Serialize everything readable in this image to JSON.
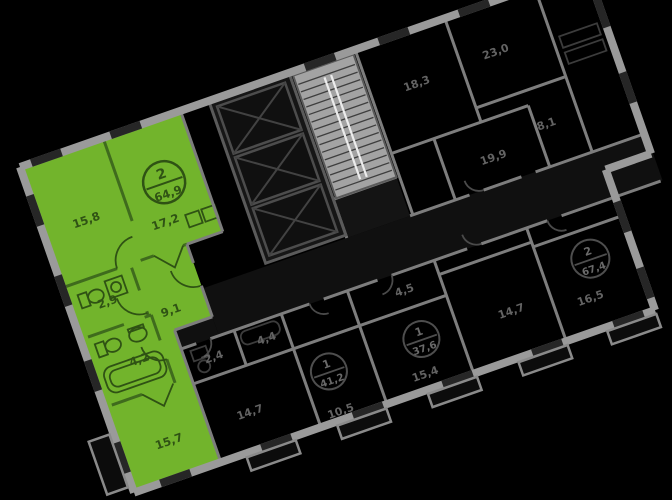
{
  "widget": {
    "name": "building-floor-plan",
    "type": "apartment-selector"
  },
  "selected_apartment": {
    "badge": {
      "rooms": "2",
      "area": "64,9"
    },
    "rooms": {
      "bedroom": "15,8",
      "living_kitchen": "17,2",
      "wc": "2,9",
      "hallway": "9,1",
      "bathroom": "4,2",
      "bedroom2": "15,7"
    },
    "highlight_color": "#72B42C"
  },
  "neighbors": {
    "b1": {
      "rooms": "1",
      "area": "41,2",
      "room_label": "10,5"
    },
    "b2": {
      "rooms": "1",
      "area": "37,6",
      "room_label": "15,4"
    },
    "b3": {
      "rooms": "2",
      "area": "67,4",
      "room_label": "16,5"
    },
    "room_labels": {
      "a1": "18,3",
      "a2": "23,0",
      "a3": "8,1",
      "a4": "19,9",
      "a5": "2,4",
      "a6": "4,4",
      "a7": "4,5",
      "a8": "14,7",
      "a9": "14,7"
    }
  },
  "colors": {
    "background": "#000000",
    "selected_fill": "#72B42C",
    "wall_light": "#9A9A9A",
    "wall_dark": "#4E4E4E",
    "window_dark": "#262626",
    "label_on_selected": "#2F5214",
    "label_dim": "#666666",
    "stair_fill": "#A3A3A3",
    "stair_rail": "#ECECEC"
  }
}
